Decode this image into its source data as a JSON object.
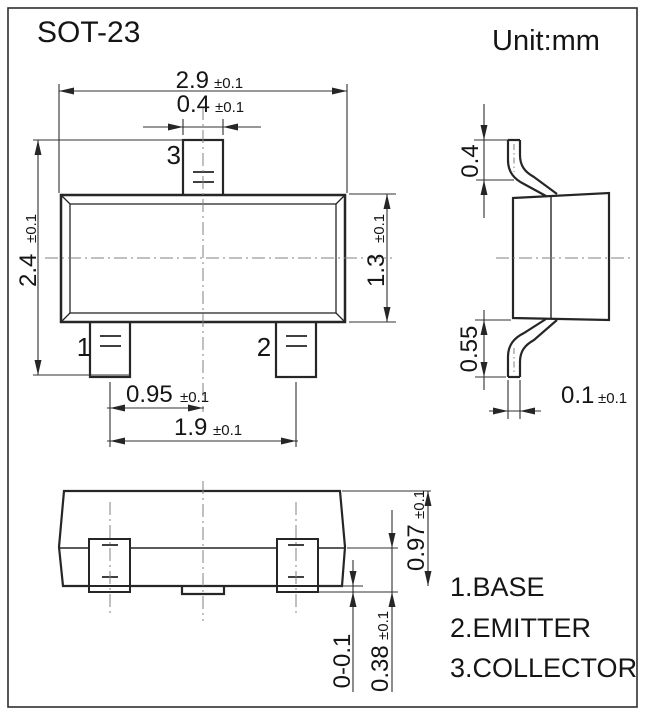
{
  "title": "SOT-23",
  "unit_label": "Unit:mm",
  "pin_labels": {
    "pin1": "1",
    "pin2": "2",
    "pin3": "3"
  },
  "legend": {
    "pin1": "1.BASE",
    "pin2": "2.EMITTER",
    "pin3": "3.COLLECTOR"
  },
  "dimensions": {
    "body_width": {
      "value": "2.9",
      "tol": "±0.1"
    },
    "tab_width": {
      "value": "0.4",
      "tol": "±0.1"
    },
    "overall_height": {
      "value": "2.4",
      "tol": "±0.1"
    },
    "body_height": {
      "value": "1.3",
      "tol": "±0.1"
    },
    "pin_pitch": {
      "value": "0.95",
      "tol": "±0.1"
    },
    "pin_span": {
      "value": "1.9",
      "tol": "±0.1"
    },
    "lead_top_height": {
      "value": "0.4"
    },
    "lead_bottom_height": {
      "value": "0.55"
    },
    "lead_thickness": {
      "value": "0.1",
      "tol": "±0.1"
    },
    "profile_height": {
      "value": "0.97",
      "tol": "±0.1"
    },
    "foot_length": {
      "value": "0.38",
      "tol": "±0.1"
    },
    "standoff": {
      "value": "0-0.1"
    }
  },
  "colors": {
    "line": "#262626",
    "centerline": "#808080",
    "text": "#151515",
    "background": "#ffffff"
  }
}
